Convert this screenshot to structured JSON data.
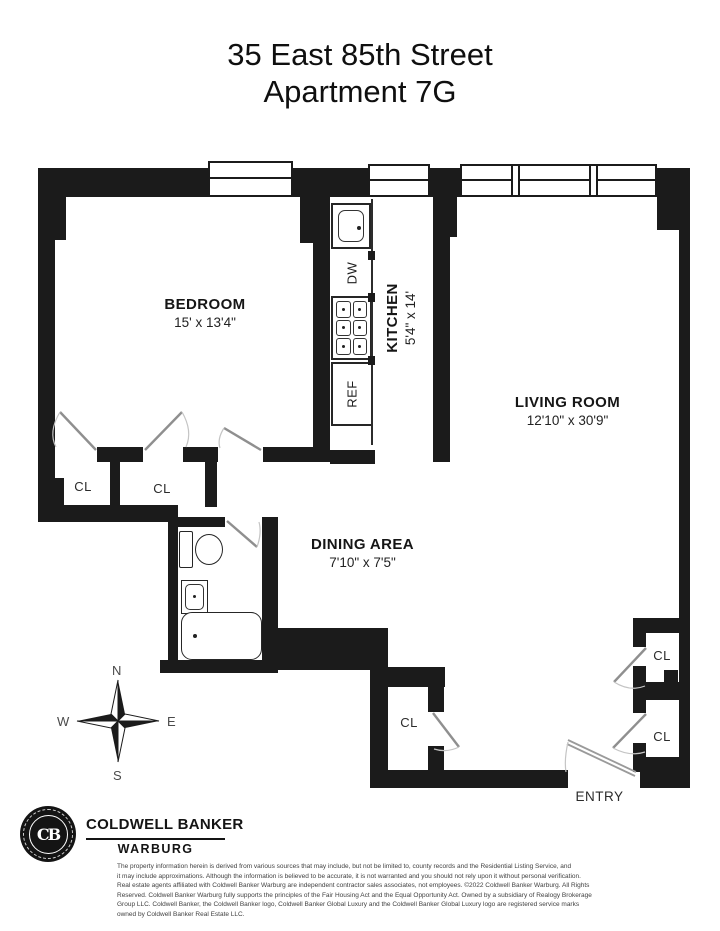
{
  "page": {
    "title_line1": "35 East 85th Street",
    "title_line2": "Apartment 7G"
  },
  "rooms": {
    "bedroom": {
      "name": "BEDROOM",
      "dims": "15' x 13'4\""
    },
    "kitchen": {
      "name": "KITCHEN",
      "dims": "5'4\" x 14'"
    },
    "living_room": {
      "name": "LIVING ROOM",
      "dims": "12'10\" x 30'9\""
    },
    "dining_area": {
      "name": "DINING AREA",
      "dims": "7'10\" x 7'5\""
    }
  },
  "labels": {
    "closet": "CL",
    "entry": "ENTRY"
  },
  "appliances": {
    "dishwasher": "DW",
    "refrigerator": "REF"
  },
  "compass": {
    "north": "N",
    "east": "E",
    "south": "S",
    "west": "W"
  },
  "brand": {
    "company": "COLDWELL BANKER",
    "division": "WARBURG",
    "monogram": "CB"
  },
  "disclaimer": {
    "lines": [
      "The property information herein is derived from various sources that may include, but not be limited to, county records and the Residential Listing Service, and",
      "it may include approximations. Although the information is believed to be accurate, it is not warranted and you should not rely upon it without personal verification.",
      "Real estate agents affiliated with Coldwell Banker Warburg are independent contractor sales associates, not employees. ©2022 Coldwell Banker Warburg. All Rights",
      "Reserved. Coldwell Banker Warburg fully supports the principles of the Fair Housing Act and the Equal Opportunity Act. Owned by a subsidiary of Realogy Brokerage",
      "Group LLC. Coldwell Banker, the Coldwell Banker logo, Coldwell Banker Global Luxury and the Coldwell Banker Global Luxury logo are registered service marks",
      "owned by Coldwell Banker Real Estate LLC."
    ]
  },
  "colors": {
    "wall": "#1b1b1b",
    "text": "#1d1d1d",
    "door_line": "#8f8f8f"
  }
}
